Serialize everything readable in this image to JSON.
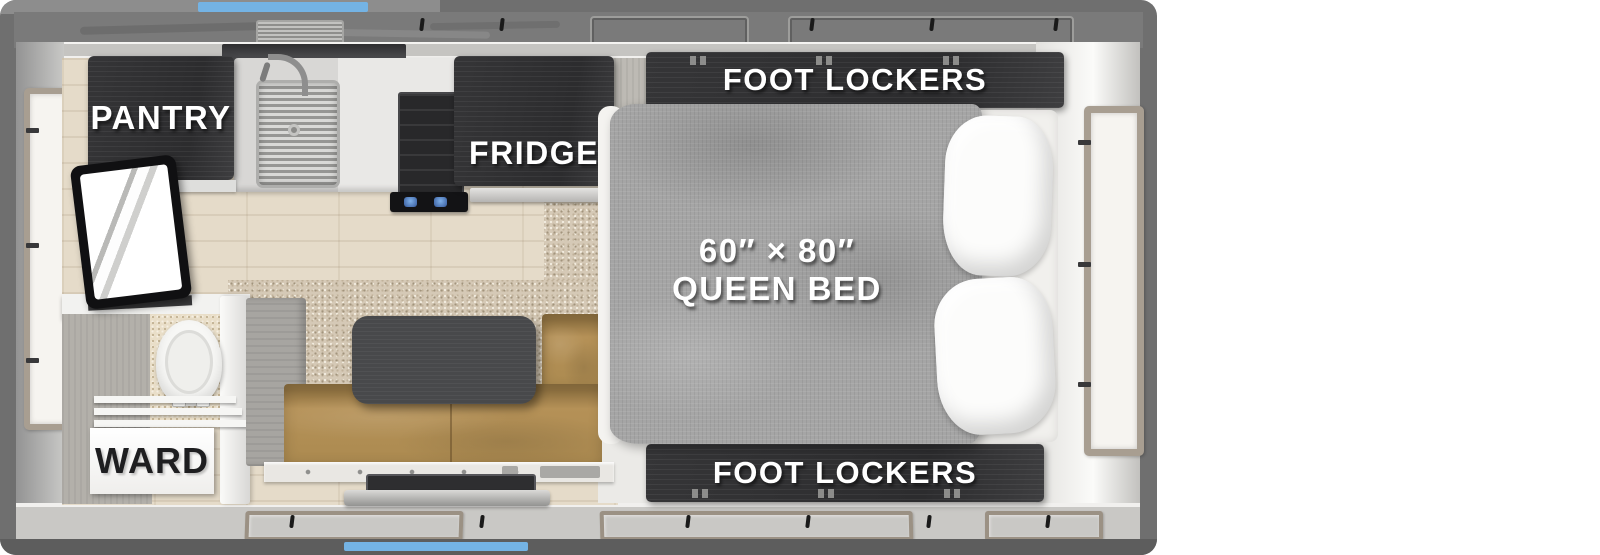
{
  "labels": {
    "pantry": "PANTRY",
    "fridge": "FRIDGE",
    "foot_lockers_top": "FOOT LOCKERS",
    "foot_lockers_bottom": "FOOT LOCKERS",
    "bed_size": "60″ × 80″",
    "bed_name": "QUEEN BED",
    "ward": "WARD"
  },
  "colors": {
    "accent_blue": "#74b3e4",
    "frame_gray": "#6f6f6f",
    "roof_gray": "#7a7a7a",
    "cabinet_dark": "#353537",
    "bench_tan": "#ab8a50",
    "bed_gray": "#a5a5a5",
    "table_gray": "#48494b",
    "floor_wood": "#e5dbc9",
    "carpet_beige": "#d5c9b6",
    "wall_light": "#c9c8c5",
    "label_white": "#ffffff",
    "label_black": "#1e1e20"
  }
}
